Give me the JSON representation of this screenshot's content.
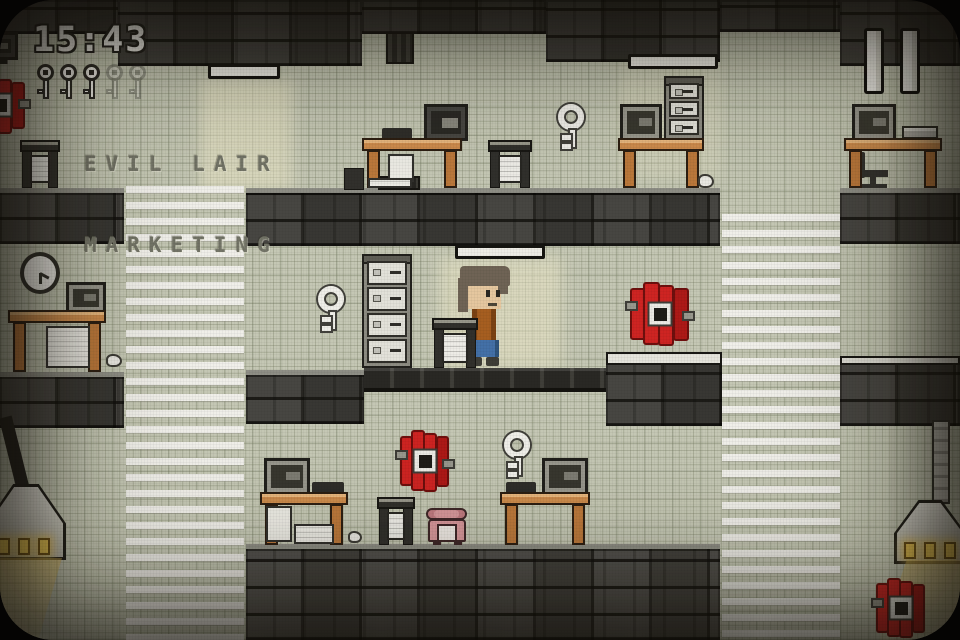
{
  "hud": {
    "timer": "15:43",
    "keys_collected": 3,
    "keys_total": 5
  },
  "sign": {
    "line1": "EVIL LAIR",
    "line2": "MARKETING"
  },
  "controls": {
    "pause": "pause"
  },
  "level": {
    "entities": {
      "player": 1,
      "desks": 6,
      "monitors": 6,
      "filing_cabinets": 2,
      "printer_stands": 4,
      "dynamite_bundles": 4,
      "floating_keys": 3,
      "wall_clock": 1,
      "telephone": 1,
      "hanging_lamps": 2,
      "ceiling_lights": 3,
      "office_chairs": 1
    }
  },
  "colors": {
    "wall": "#c9cdbb",
    "brick": "#3b3b39",
    "dynamite_red": "#d32121",
    "desk_wood": "#d28f4e",
    "key_white": "#f6f6f2",
    "phone_pink": "#dc9aa0",
    "lamp_glow": "#f2cd55",
    "hud_text": "#f2f2ee",
    "sign_text": "#73756a",
    "player_shirt": "#a95e1f",
    "player_pants": "#4171ad"
  }
}
